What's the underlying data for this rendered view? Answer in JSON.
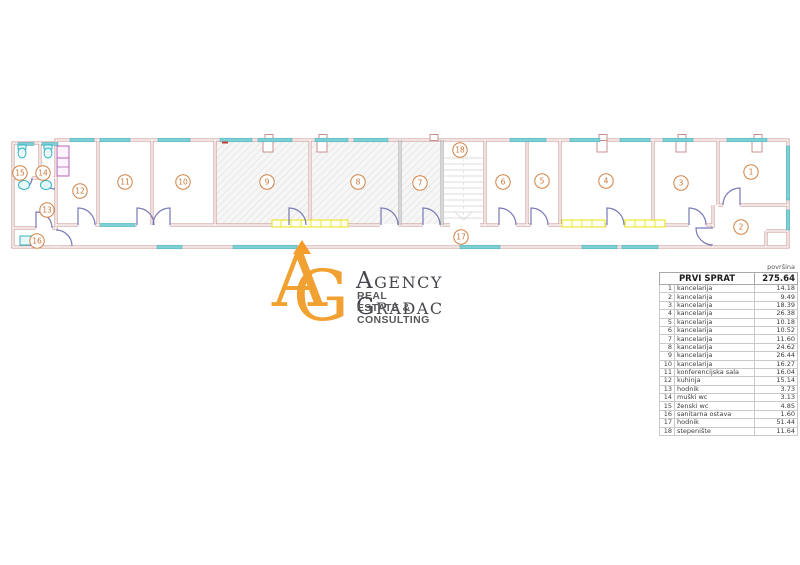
{
  "logo": {
    "monogram_a": "A",
    "monogram_g": "G",
    "name": "Agency Gradac",
    "tagline": "REAL ESTATE & CONSULTING"
  },
  "colors": {
    "logo_orange": "#f0a132",
    "wall_pink": "#c98f8f",
    "window_cyan": "#7fd0d4",
    "door_purple": "#7878b6",
    "radiator_yellow": "#e8e414",
    "room_label_orange": "#d08244"
  },
  "plan": {
    "rooms": [
      {
        "number": "1",
        "x": 751,
        "y": 172
      },
      {
        "number": "2",
        "x": 741,
        "y": 227
      },
      {
        "number": "3",
        "x": 681,
        "y": 183
      },
      {
        "number": "4",
        "x": 606,
        "y": 181
      },
      {
        "number": "5",
        "x": 542,
        "y": 181
      },
      {
        "number": "6",
        "x": 503,
        "y": 182
      },
      {
        "number": "7",
        "x": 420,
        "y": 183
      },
      {
        "number": "8",
        "x": 358,
        "y": 182
      },
      {
        "number": "9",
        "x": 267,
        "y": 182
      },
      {
        "number": "10",
        "x": 183,
        "y": 182
      },
      {
        "number": "11",
        "x": 125,
        "y": 182
      },
      {
        "number": "12",
        "x": 80,
        "y": 191
      },
      {
        "number": "13",
        "x": 47,
        "y": 210
      },
      {
        "number": "14",
        "x": 43,
        "y": 173
      },
      {
        "number": "15",
        "x": 20,
        "y": 173
      },
      {
        "number": "16",
        "x": 37,
        "y": 241
      },
      {
        "number": "17",
        "x": 461,
        "y": 237
      },
      {
        "number": "18",
        "x": 460,
        "y": 150
      }
    ]
  },
  "table": {
    "corner_label": "površina",
    "title": "PRVI SPRAT",
    "total": "275.64",
    "rows": [
      {
        "n": "1",
        "name": "kancelarija",
        "area": "14.18"
      },
      {
        "n": "2",
        "name": "kancelarija",
        "area": "9.49"
      },
      {
        "n": "3",
        "name": "kancelarija",
        "area": "18.39"
      },
      {
        "n": "4",
        "name": "kancelarija",
        "area": "26.38"
      },
      {
        "n": "5",
        "name": "kancelarija",
        "area": "10.18"
      },
      {
        "n": "6",
        "name": "kancelarija",
        "area": "10.52"
      },
      {
        "n": "7",
        "name": "kancelarija",
        "area": "11.60"
      },
      {
        "n": "8",
        "name": "kancelarija",
        "area": "24.62"
      },
      {
        "n": "9",
        "name": "kancelarija",
        "area": "26.44"
      },
      {
        "n": "10",
        "name": "kancelarija",
        "area": "16.27"
      },
      {
        "n": "11",
        "name": "konferencijska sala",
        "area": "16.04"
      },
      {
        "n": "12",
        "name": "kuhinja",
        "area": "15.14"
      },
      {
        "n": "13",
        "name": "hodnik",
        "area": "3.73"
      },
      {
        "n": "14",
        "name": "muški wc",
        "area": "3.13"
      },
      {
        "n": "15",
        "name": "ženski wc",
        "area": "4.85"
      },
      {
        "n": "16",
        "name": "sanitarna ostava",
        "area": "1.60"
      },
      {
        "n": "17",
        "name": "hodnik",
        "area": "51.44"
      },
      {
        "n": "18",
        "name": "stepenište",
        "area": "11.64"
      }
    ]
  }
}
